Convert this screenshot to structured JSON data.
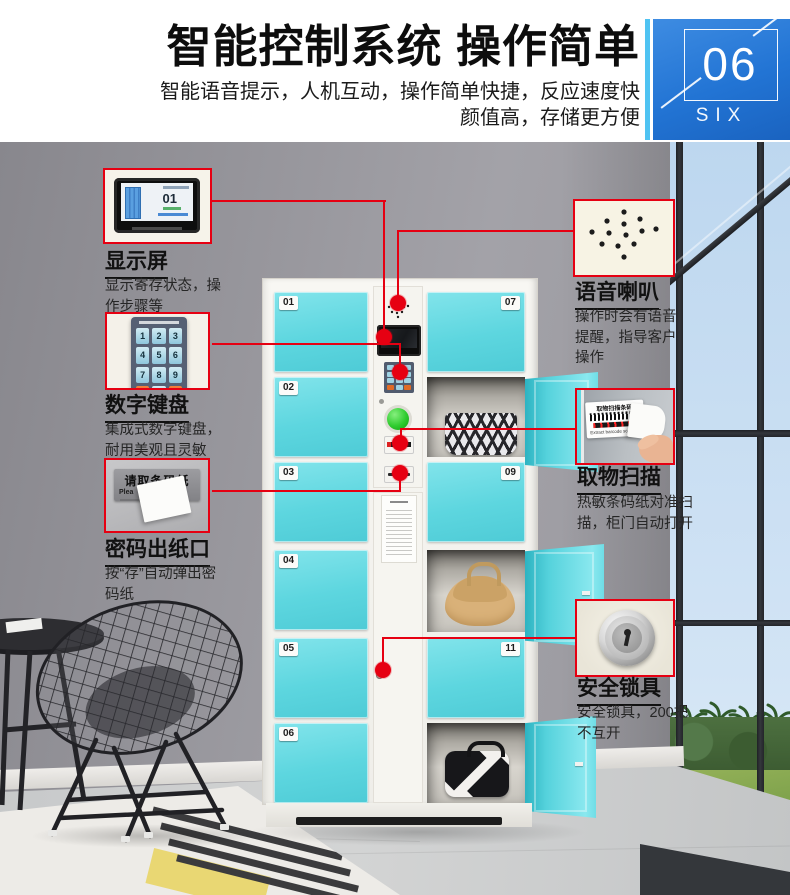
{
  "header": {
    "title": "智能控制系统 操作简单",
    "subtitle_line1": "智能语音提示，人机互动，操作简单快捷，反应速度快",
    "subtitle_line2": "颜值高，存储更方便",
    "badge": {
      "number": "06",
      "word": "SIX"
    }
  },
  "callouts": {
    "display": {
      "title": "显示屏",
      "desc": "显示寄存状态，操作步骤等",
      "screen_number": "01"
    },
    "keypad": {
      "title": "数字键盘",
      "desc": "集成式数字键盘，耐用美观且灵敏",
      "keys": [
        "1",
        "2",
        "3",
        "4",
        "5",
        "6",
        "7",
        "8",
        "9",
        "0"
      ]
    },
    "paper_outlet": {
      "title": "密码出纸口",
      "desc": "按“存”自动弹出密码纸",
      "sign": "请取条码纸",
      "sign_partial_en": "Plea"
    },
    "speaker": {
      "title": "语音喇叭",
      "desc": "操作时会有语音提醒，指导客户操作"
    },
    "scan": {
      "title": "取物扫描",
      "desc": "热敏条码纸对准扫描，柜门自动打开",
      "label": "取物扫描条码",
      "label_en": "Extract barcode scanning"
    },
    "lock": {
      "title": "安全锁具",
      "desc": "安全锁具，200把不互开"
    }
  },
  "locker": {
    "left_door_labels": [
      "01",
      "02",
      "03",
      "04",
      "05",
      "06"
    ],
    "right_door_labels": [
      "07",
      "09",
      "11"
    ]
  },
  "colors": {
    "accent_red": "#e60012",
    "door_cyan": "#5cd6e0",
    "badge_blue": "#2274d4",
    "sky_blue": "#cfe2f4"
  }
}
